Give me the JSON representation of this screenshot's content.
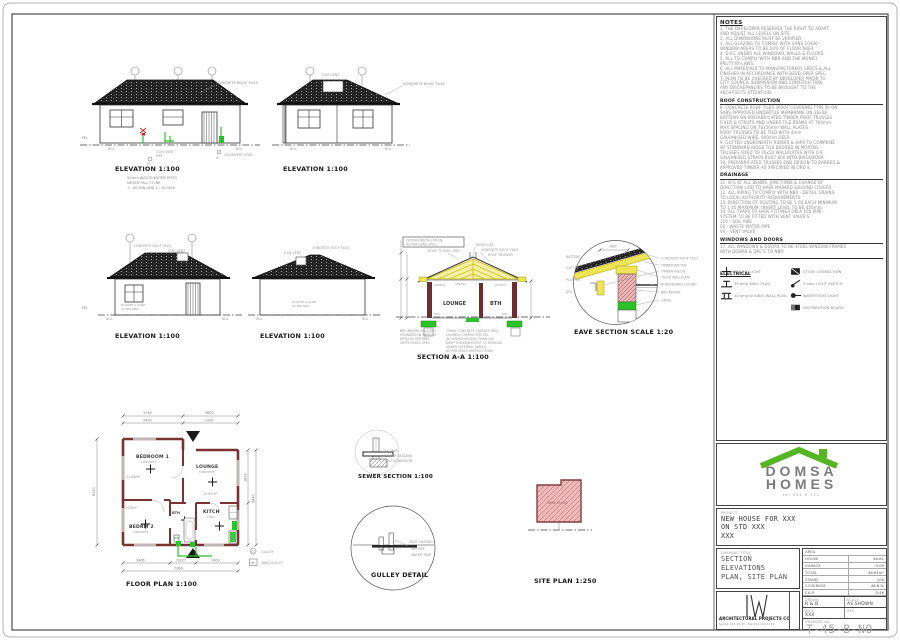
{
  "colors": {
    "wall_maroon": "#7a3333",
    "truss_yellow": "#efe96a",
    "brick_pink": "#edb8b8",
    "plumbing_green": "#2cc22c",
    "logo_green": "#55b522",
    "roof_tile_dark": "#1e1e1e"
  },
  "sheet": {
    "elev1": {
      "title": "ELEVATION 1:100",
      "roof": "CONCRETE ROOF TILES",
      "ffl": "FFL",
      "ngl_l": "NGL",
      "ngl_r": "NGL",
      "vent1": "110V VENT",
      "vent2": "PIPE",
      "invert": "450 INVERT LEVEL",
      "ie1": "IE",
      "ie2": "IE",
      "note1": "50mm WASTE WATER PIPES",
      "note2": "NEVER FALL TO BE",
      "note3": "1 : 60 MIN AND 1 : 40 MAX"
    },
    "elev2": {
      "title": "ELEVATION 1:100",
      "roof": "CONCRETE ROOF TILES",
      "vent": "S DE VENT",
      "ngl_l": "NGL",
      "ngl_r": "NGL"
    },
    "elev3": {
      "title": "ELEVATION 1:100",
      "roof": "CONCRETE ROOF TILES",
      "vent": "S DE VENT",
      "plaster1": "PLASTER & PAINT",
      "plaster2": "AS PER SPEC",
      "ffl": "FFL",
      "ngl_l": "NGL",
      "ngl_r": "NGL"
    },
    "elev4": {
      "title": "ELEVATION 1:100",
      "roof": "CONCRETE ROOF TILES",
      "vent": "S DE VENT",
      "plaster1": "PLASTER & PAINT",
      "plaster2": "AS PER SPEC",
      "ngl_l": "NGL",
      "ngl_r": "NGL"
    },
    "section": {
      "title": "SECTION A-A 1:100",
      "gey1": "GEYSER INSTALLATION",
      "gey2": "AS PER SANS SPEC",
      "roof_spec": "ROOF TO ENG. SPEC",
      "ridge": "RIDGE CAP",
      "tiles": "CONCRETE ROOF TILES",
      "trusses": "ROOF TRUSSES",
      "lintels_l": "LINTELS",
      "ceiling": "CEILING",
      "lintels_r": "LINTELS",
      "room_l": "LOUNGE",
      "room_r": "BTH",
      "dpc_l": "DPC",
      "dpc_r": "DPC",
      "fnote1": "BRICKWORK ON CONC",
      "fnote2": "FOUNDATION 700x230",
      "fnote3": "DPTH AS PER NBR",
      "fnote4": "OR TO ENG'S SPEC",
      "bnote1": "75mm CONCRETE SURFACE BED",
      "bnote2": "ON WELL COMPACTED FILL",
      "bnote3": "IN LAYERS NO LESS THAN 150",
      "bnote4": "DEEP THICKENED OUT TO 600x200",
      "bnote5": "UNDER INTERNAL WALLS",
      "bnote6": "AS PER ENG'S INSTRUCTIONS"
    },
    "eave": {
      "title": "EAVE SECTION SCALE 1:20",
      "dim": "500",
      "r1": "CONCRETE ROOF TILES",
      "r2": "TIMBER RAFTER",
      "r3": "TIMBER FASCIA",
      "r4": "76x50 WALLPLATE",
      "r5": "RHINOBOARD CEILING",
      "r6": "BRICKWORK",
      "r7": "LINTEL",
      "l1": "BATTENS",
      "l2": "GUTTER",
      "l3": "PLASTER",
      "l4": "DPC"
    },
    "plan": {
      "title": "FLOOR PLAN 1:100",
      "bed1": "BEDROOM 1",
      "bed1_fin": "CONCRETE",
      "bed1_area": "11.89m²",
      "lounge": "LOUNGE",
      "lounge_fin": "CONCRETE",
      "lounge_area": "11.97m²",
      "bed2": "BEDRM 2",
      "bed2_fin": "CONCRETE",
      "bed2_area": "7.03m²",
      "kitch": "KITCH",
      "kitch_fin": "CONC",
      "bth": "BTH",
      "d_top1": "3746",
      "d_top2": "3620",
      "d_top3": "2490",
      "d_top4": "2430",
      "d_left": "6040",
      "d_right1": "2490",
      "d_right2": "5440",
      "d_bot1": "3966",
      "d_bot2": "2000",
      "d_bot3": "1400",
      "d_total": "7366",
      "leg1_sym": "G",
      "leg1": "-  GULLEY",
      "leg2_sym": "YE",
      "leg2": "-  YARD GULLEY"
    },
    "sewer": {
      "title": "SEWER SECTION 1:100",
      "l1": "SOIL PIPE",
      "l2": "SEWER BEDDING",
      "l3": "ON FOUNDATION"
    },
    "gulley": {
      "title": "GULLEY DETAIL",
      "l1": "VENT GRATING",
      "l2": "100 PIPE",
      "l3": "WATER TRAP"
    },
    "site": {
      "title": "SITE PLAN 1:250",
      "house": "NEW HOUSE"
    }
  },
  "panel": {
    "notes": {
      "heading": "NOTES",
      "general": [
        "1.  THE DEVELOPER RESERVES THE RIGHT TO ADAPT",
        "    AND ADJUST ALL LEVELS ON SITE.",
        "2.  ALL DIMENSIONS MUST BE VERIFIED.",
        "3.  ALL GLAZING TO COMPLY WITH SANS 10400 -",
        "    WINDOW AREAS TO BE 10% OF FLOOR AREA.",
        "4.  D.P.C UNDER ALL WINDOWS, WALLS & FLOORS.",
        "5.  ALL TO COMPLY WITH NBR AND THE MUNICI-",
        "    PALITY BY-LAWS.",
        "6.  ALL MATERIALS TO MANUFACTURERS SPECS & ALL",
        "    FINISHES IN ACCORDANCE WITH DEVELOPER SPEC.",
        "7.  PLAN TO BE CHECKED BY DEVELOPER PRIOR TO",
        "    CITY COUNCIL SUBMISSION AND CONSTRUCTION.",
        "    ANY DISCREPANCIES TO BE BROUGHT TO THE",
        "    ARCHITECTS ATTENTION."
      ],
      "roof_heading": "ROOF CONSTRUCTION",
      "roof": [
        "8.  CONCRETE ROOF TILES (ROOF COVERING TYPE B) ON",
        "    SABS APPROVED UNDERTILE MEMBRANE ON 38x38",
        "    BATTENS ON PREFABRICATED TIMBER ROOF TRUSSES",
        "    FIXED & STRUTS AND UNDER TILE BEAMS AT 760mm",
        "    MAX SPACING ON 76x50mm WALL PLATES.",
        "    ROOF TRUSSES TO BE TIED WITH 4mm",
        "    GALVANISED WIRE, 900mm DEEP.",
        "9.  GUTTER UNDERNEATH RIDGES & HIPS TO COMPRISE",
        "    OF STANDARD RIDGE TILE BEDDED IN MORTAR.",
        "    TRUSSES FIXED TO 76x50 WALLPLATES WITH 0.8",
        "    GALVANISED STRAPS BUILT 600 INTO BRICKWORK.",
        "10. PREFABRICATED TRUSSES END DESIGN TO BARRED &",
        "    APPROVED TIMBER AS SPECIFIED IN ORD 8."
      ],
      "drain_heading": "DRAINAGE",
      "drain": [
        "11. IE'S AT ALL BENDS, JUNCTIONS & CHANGE OF",
        "    DIRECTION LAID TO HAVE MARKED GROUND COVERS.",
        "12. ALL PIPING TO COMPLY WITH NBR - DETAIL DRAINS",
        "    TO LOCAL AUTHORITY REQUIREMENTS.",
        "13. DIRECTION OF ROUTING TO BE 1:60 EACH MINIMUM",
        "    TO 1:40 MAXIMUM. INVERT LEVEL TO BE 450mm.",
        "14. ALL TRAPS TO HAVE FITTINGS ON A 100 PIPE -",
        "    SYSTEM TO BE FITTED WITH VENT VALVE'S.",
        "      110  -  SOIL PIPE",
        "      50   -  WASTE WATER PIPE",
        "      VV   -  VENT VALVE"
      ],
      "windows_heading": "WINDOWS AND DOORS",
      "windows": [
        "17. ALL WINDOWS & DOORS TO BE STEEL WINDOW FRAMES",
        "    WITH DOORS & DPC'S TO NBR."
      ]
    },
    "electrical": {
      "heading": "ELECTRICAL",
      "l1": "CEILING LIGHT",
      "l2": "30 amp WALL PLUG",
      "l3": "30 amp DOUBLE WALL PLUG",
      "r1": "STOVE CONNECTION",
      "r2": "5 amp LIGHT SWITCH",
      "r3": "WATERTIGHT LIGHT",
      "r4": "DISTRIBUTION BOARD"
    },
    "logo": {
      "name1": "DOMSA",
      "name2": "HOMES",
      "tagline": "tel 011 5 111"
    },
    "project": {
      "label": "PROJECT",
      "lines": [
        "NEW HOUSE FOR XXX",
        "ON STD XXX",
        "XXX"
      ]
    },
    "title_block": {
      "label": "DRAWING TITLE",
      "lines": [
        "SECTION",
        "ELEVATIONS",
        "PLAN, SITE PLAN"
      ]
    },
    "area": {
      "header": "AREA",
      "r1l": "HOUSE",
      "r1v": "46.61",
      "r2l": "GARAGE",
      "r2v": "0.00",
      "r3l": "TOTAL",
      "r3v": "46.61m²",
      "r4l": "STAND",
      "r4v": "100",
      "r5l": "COVERAGE",
      "r5v": "46.6 %",
      "r6l": "F.A.R",
      "r6v": "0.46"
    },
    "meta": {
      "drawn_l": "DRAWN",
      "drawn": "R & B",
      "scale_l": "SCALE",
      "scale": "AS SHOWN",
      "date_l": "DATE",
      "date": "XXX",
      "rev_l": "REV",
      "rev": "",
      "dwg_l": "DRAWING No.",
      "dwg": "T-45-B-NO"
    },
    "architect": {
      "name": "ARCHITECTURAL PROJECTS CC",
      "contact": "te 011 111 11 11 - fax 011 111 1111"
    }
  }
}
